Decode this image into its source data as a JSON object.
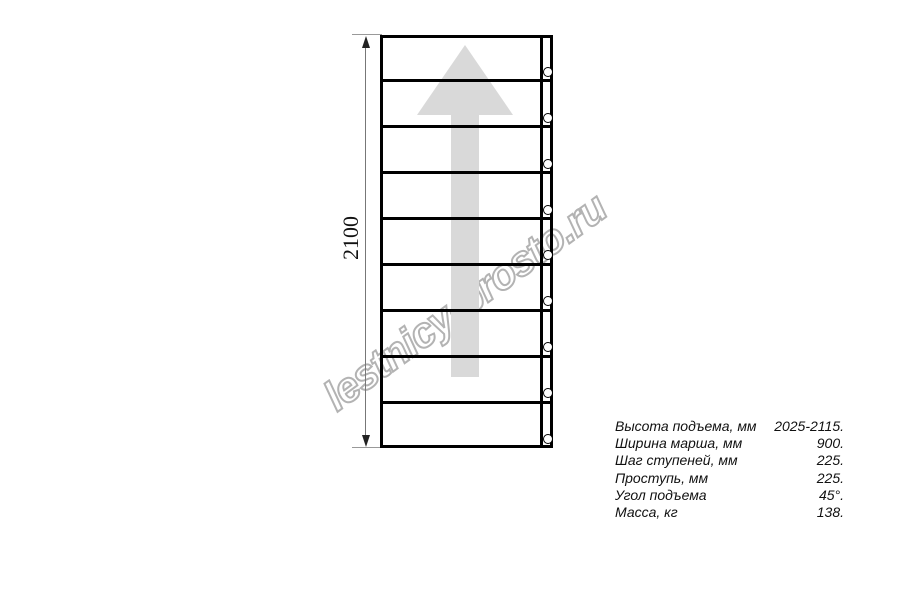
{
  "page": {
    "background": "#ffffff",
    "line_color": "#000000"
  },
  "watermark": {
    "text": "lestnicy-prosto.ru",
    "color": "#b3b3b3"
  },
  "stair_plan": {
    "treads": 9,
    "holes": 9,
    "arrow_color": "#d9d9d9",
    "dimension_label": "2100"
  },
  "specs": {
    "rows": [
      {
        "label": "Высота подъема, мм",
        "value": "2025-2115."
      },
      {
        "label": "Ширина марша, мм",
        "value": "900."
      },
      {
        "label": "Шаг ступеней, мм",
        "value": "225."
      },
      {
        "label": "Проступь, мм",
        "value": "225."
      },
      {
        "label": "Угол подъема",
        "value": "45°."
      },
      {
        "label": "Масса, кг",
        "value": "138."
      }
    ]
  }
}
